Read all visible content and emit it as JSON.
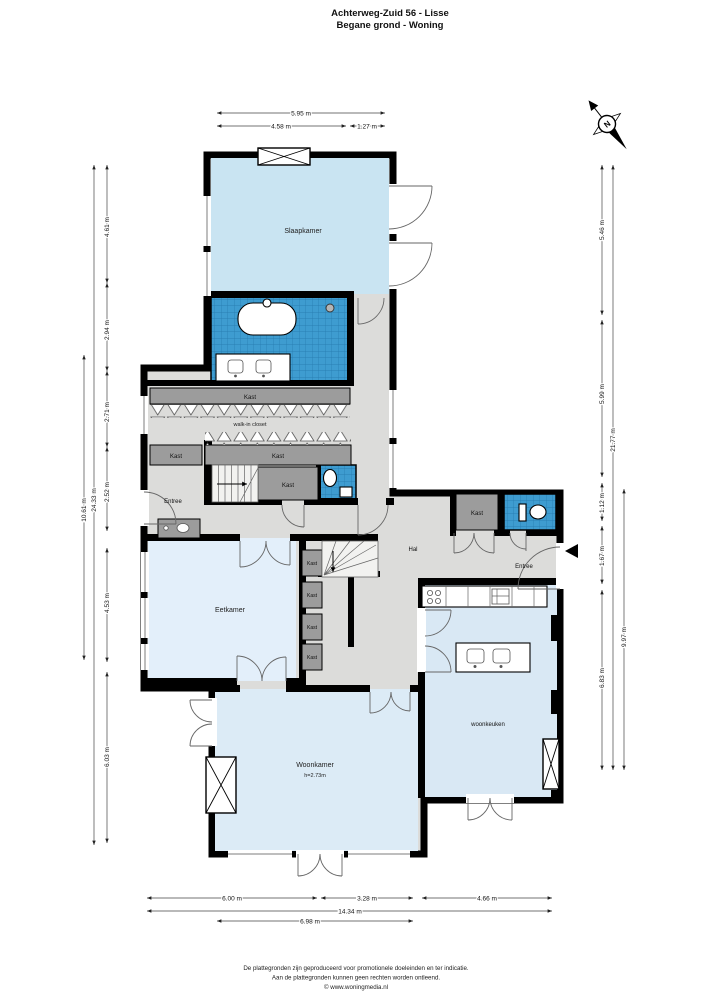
{
  "title": {
    "line1": "Achterweg-Zuid 56 - Lisse",
    "line2": "Begane grond - Woning"
  },
  "compass": {
    "north": "N"
  },
  "labels": {
    "slaapkamer": "Slaapkamer",
    "kast": "Kast",
    "walk_in_closet": "walk-in closet",
    "entree": "Entree",
    "hal": "Hal",
    "eetkamer": "Eetkamer",
    "woonkamer": "Woonkamer",
    "woonkamer_height": "h=2.73m",
    "woonkeuken": "woonkeuken"
  },
  "dims": {
    "top": [
      "5.95 m",
      "4.58 m",
      "1.27 m"
    ],
    "left": [
      "4.61 m",
      "2.94 m",
      "2.71 m",
      "2.52 m",
      "4.53 m",
      "6.03 m",
      "10.61 m",
      "24.33 m"
    ],
    "right": [
      "5.46 m",
      "5.99 m",
      "1.12 m",
      "1.67 m",
      "6.83 m",
      "21.77 m",
      "9.97 m"
    ],
    "bottom": [
      "6.00 m",
      "3.28 m",
      "4.66 m",
      "14.34 m",
      "6.98 m"
    ]
  },
  "footer": {
    "line1": "De plattegronden zijn geproduceerd voor promotionele doeleinden en ter indicatie.",
    "line2": "Aan de plattegronden kunnen geen rechten worden ontleend.",
    "line3": "© www.woningmedia.nl"
  },
  "colors": {
    "room_blue": "#c9e4f2",
    "room_blue_pale": "#e3effa",
    "room_blue_soft": "#d9e8f4",
    "tile_blue": "#3e9cd0",
    "closet_gray": "#9c9c9c",
    "floor_gray": "#dcdcda",
    "wall_black": "#000000"
  }
}
